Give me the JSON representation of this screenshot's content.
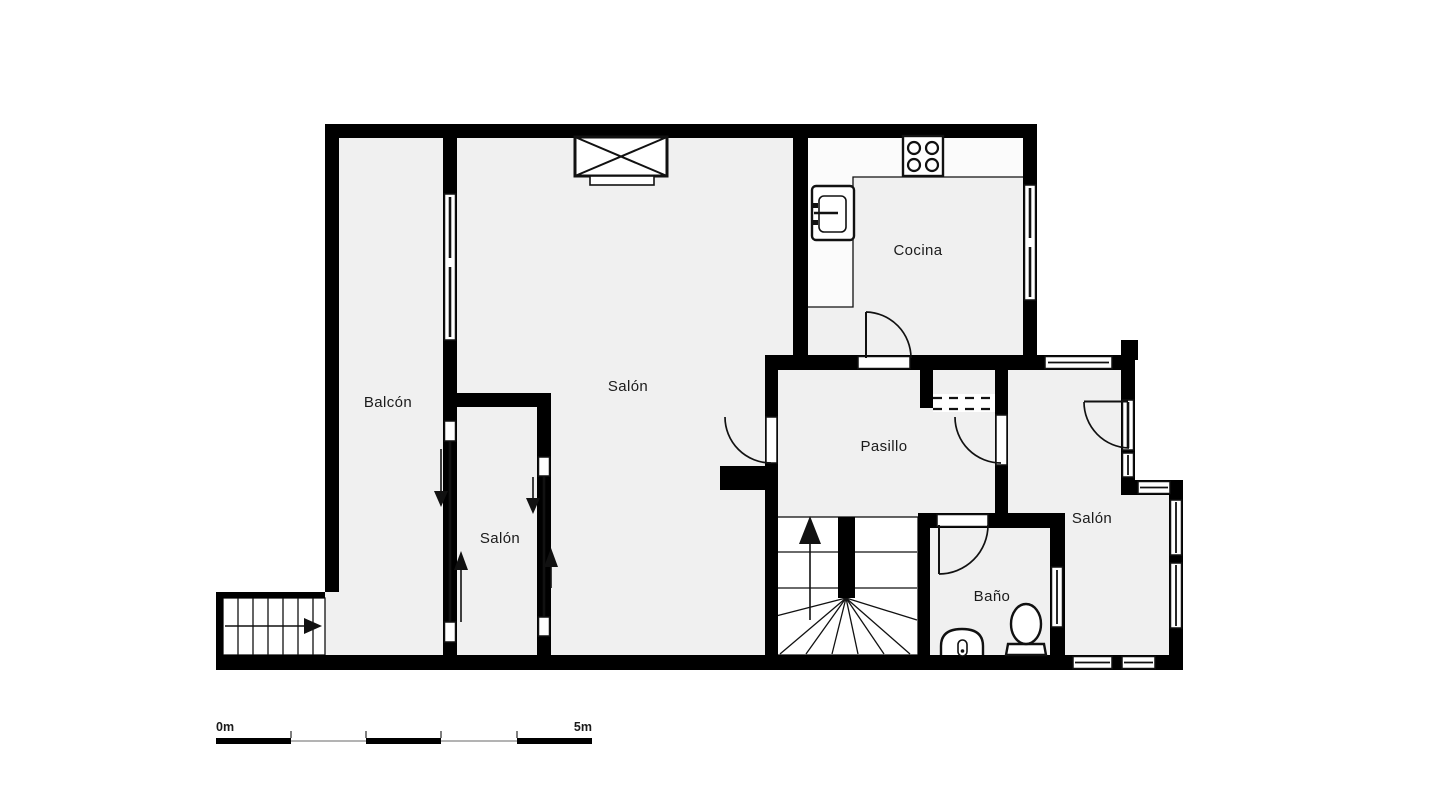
{
  "colors": {
    "background": "#ffffff",
    "wall": "#000000",
    "floor": "#f0f0f0",
    "counter": "#fbfbfb",
    "line": "#111111",
    "label": "#1b1b1b",
    "scale_thin": "#9a9a9a"
  },
  "rooms": [
    {
      "id": "balcon",
      "label": "Balcón"
    },
    {
      "id": "salon-main",
      "label": "Salón"
    },
    {
      "id": "salon-small",
      "label": "Salón"
    },
    {
      "id": "cocina",
      "label": "Cocina"
    },
    {
      "id": "pasillo",
      "label": "Pasillo"
    },
    {
      "id": "bano",
      "label": "Baño"
    },
    {
      "id": "salon-right",
      "label": "Salón"
    }
  ],
  "scale_bar": {
    "start_label": "0m",
    "end_label": "5m"
  },
  "icons": {
    "stove-icon": "four-burner-cooktop",
    "kitchen-sink-icon": "basin-with-faucet",
    "fireplace-icon": "crossed-box-with-hearth",
    "toilet-icon": "bowl-with-base",
    "bidet-icon": "rounded-fixture",
    "stairs-up-arrow-icon": "arrow-up",
    "entrance-arrow-icon": "arrow-right",
    "sliding-door-arrow-icon": "arrow-pair"
  }
}
